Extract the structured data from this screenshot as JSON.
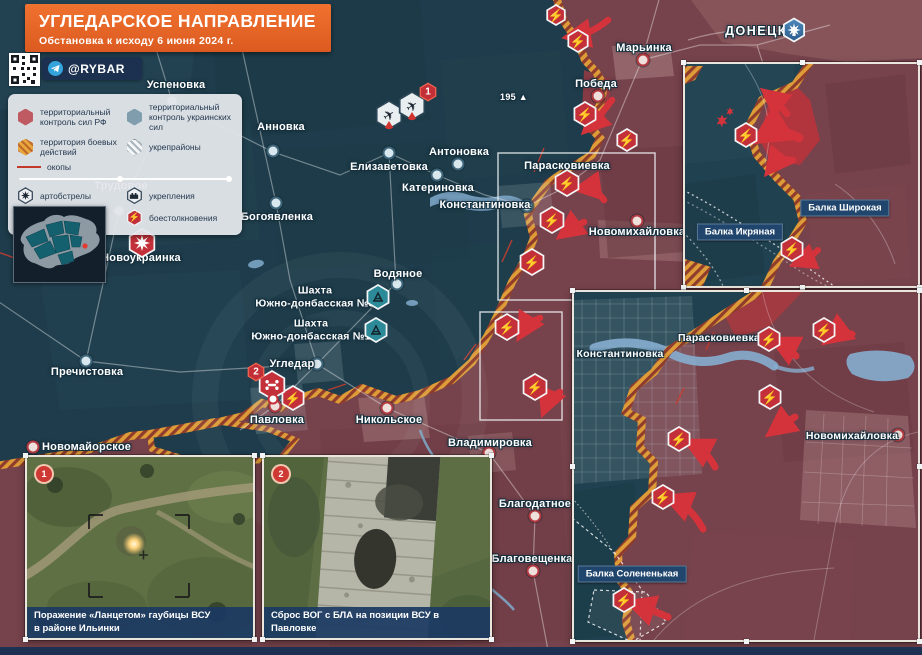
{
  "header": {
    "title": "УГЛЕДАРСКОЕ НАПРАВЛЕНИЕ",
    "subtitle": "Обстановка к исходу 6 июня 2024 г.",
    "channel": "@RYBAR"
  },
  "legend": {
    "rf": "территориальный контроль сил РФ",
    "ua": "территориальный контроль украинских сил",
    "combat": "территория боевых действий",
    "forts": "укрепрайоны",
    "trenches": "окопы",
    "artillery": "артобстрелы",
    "fortifications": "укрепления",
    "airstrikes": "авиаудары",
    "clashes": "боестолкновения"
  },
  "map": {
    "towns": [
      {
        "name": "Успеновка"
      },
      {
        "name": "Анновка"
      },
      {
        "name": "Трудовое"
      },
      {
        "name": "Елизаветовка"
      },
      {
        "name": "Антоновка"
      },
      {
        "name": "Катериновка"
      },
      {
        "name": "Константиновка"
      },
      {
        "name": "Богоявленка"
      },
      {
        "name": "Новоукраинка"
      },
      {
        "name": "Пречистовка"
      },
      {
        "name": "Водяное"
      },
      {
        "name": "Угледар"
      },
      {
        "name": "Павловка"
      },
      {
        "name": "Никольское"
      },
      {
        "name": "Новомайорское"
      },
      {
        "name": "Владимировка"
      },
      {
        "name": "Благодатное"
      },
      {
        "name": "Благовещенка"
      },
      {
        "name": "Марьинка"
      },
      {
        "name": "Победа"
      },
      {
        "name": "Парасковиевка"
      },
      {
        "name": "Новомихайловка"
      }
    ],
    "city": "ДОНЕЦК",
    "elevation": "195 ▲",
    "mine3": "Шахта\nЮжно-донбасская №3",
    "mine1": "Шахта\nЮжно-донбасская №1",
    "badge_air": "1",
    "badge_pavlovka": "2"
  },
  "inset_top_right": {
    "balka_shirokaya": "Балка Широкая",
    "balka_ikryanaya": "Балка Икряная"
  },
  "inset_bottom_right": {
    "konstantinovka": "Константиновка",
    "paraskovievka": "Парасковиевка",
    "novomikhailovka": "Новомихайловка",
    "balka_solenenkaya": "Балка Солененькая"
  },
  "photos": [
    {
      "num": "1",
      "caption": "Поражение «Ланцетом» гаубицы ВСУ\nв районе Ильинки"
    },
    {
      "num": "2",
      "caption": "Сброс ВОГ с БЛА на позиции ВСУ в Павловке"
    }
  ],
  "colors": {
    "rf_zone": "#76424b",
    "ua_zone": "#1e3c4b",
    "combat_hatch": "#dd9c38",
    "clash_red": "#c4303a",
    "accent_orange": "#ec6528",
    "navy": "#1d3152",
    "telegram_blue": "#34a5dc"
  }
}
